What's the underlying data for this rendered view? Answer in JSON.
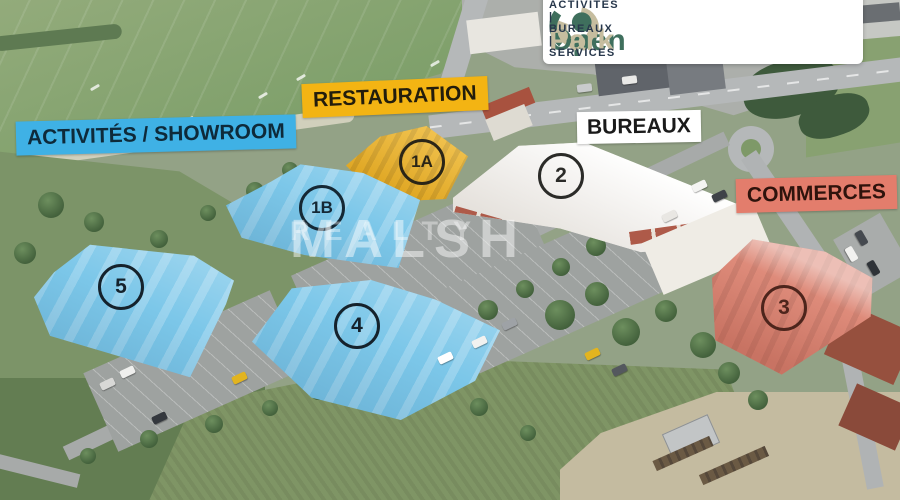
{
  "title": "OpenPark – vue aérienne du plan masse",
  "logo": {
    "brand_open": "Open",
    "brand_park": "Park",
    "tagline": "ACTIVITÉS | BUREAUX | SERVICES",
    "colors": {
      "green": "#3F6F5D",
      "beige": "#C6BD9F",
      "navy": "#27374B",
      "card": "#FFFFFF"
    }
  },
  "watermark": {
    "line1": "MALSH",
    "line2": "REALTY"
  },
  "zones": {
    "activites": {
      "label": "ACTIVITÉS / SHOWROOM",
      "bg": "#3FB1E5",
      "building_color": "#7CC7E9"
    },
    "restauration": {
      "label": "RESTAURATION",
      "bg": "#F3B413",
      "building_color": "#F2B722"
    },
    "bureaux": {
      "label": "BUREAUX",
      "bg": "#FFFFFF",
      "building_color": "#F2EFE9"
    },
    "commerces": {
      "label": "COMMERCES",
      "bg": "#E37D6C",
      "building_color": "#DE8B7A"
    }
  },
  "buildings": [
    {
      "badge": "1A",
      "zone": "restauration"
    },
    {
      "badge": "1B",
      "zone": "activites"
    },
    {
      "badge": "2",
      "zone": "bureaux"
    },
    {
      "badge": "3",
      "zone": "commerces"
    },
    {
      "badge": "4",
      "zone": "activites"
    },
    {
      "badge": "5",
      "zone": "activites"
    }
  ]
}
